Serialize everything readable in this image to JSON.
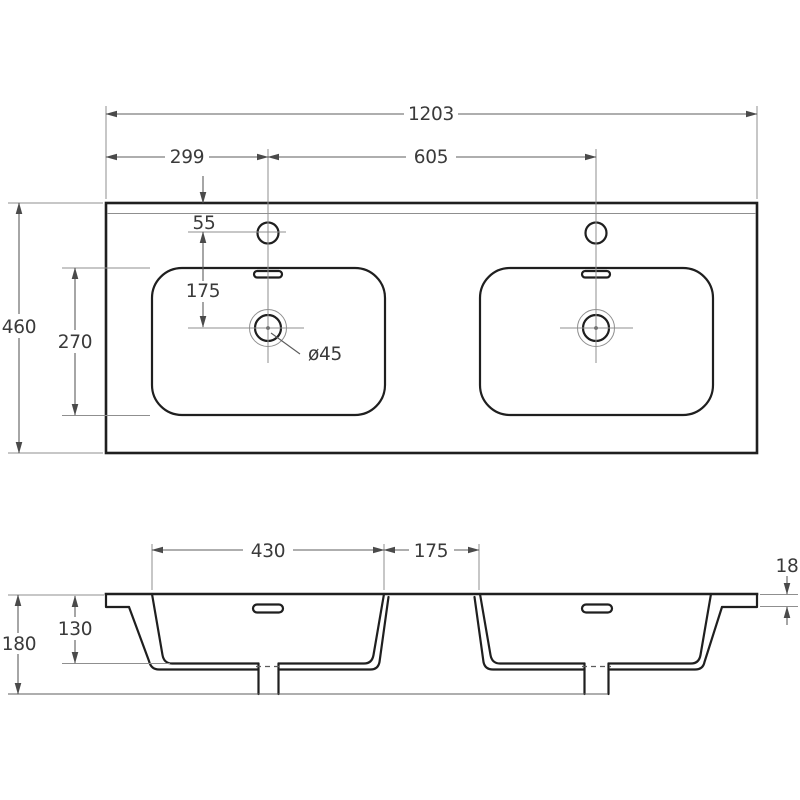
{
  "colors": {
    "background": "#ffffff",
    "outline": "#1f1f1f",
    "thin_line": "#8f8f8f",
    "dimension_line": "#5c5c5c",
    "text": "#3a3a3a"
  },
  "top_view": {
    "dim_overall_width": "1203",
    "dim_faucet_center_from_left": "299",
    "dim_faucet_center_spacing": "605",
    "dim_faucet_from_back_edge": "55",
    "dim_faucet_to_drain": "175",
    "dim_overall_depth": "460",
    "dim_basin_front_to_back": "270",
    "label_drain_diameter": "ø45"
  },
  "section_view": {
    "dim_basin_opening_width": "430",
    "dim_between_basins": "175",
    "dim_rim_height": "18",
    "dim_basin_inner_depth": "130",
    "dim_overall_height": "180"
  }
}
